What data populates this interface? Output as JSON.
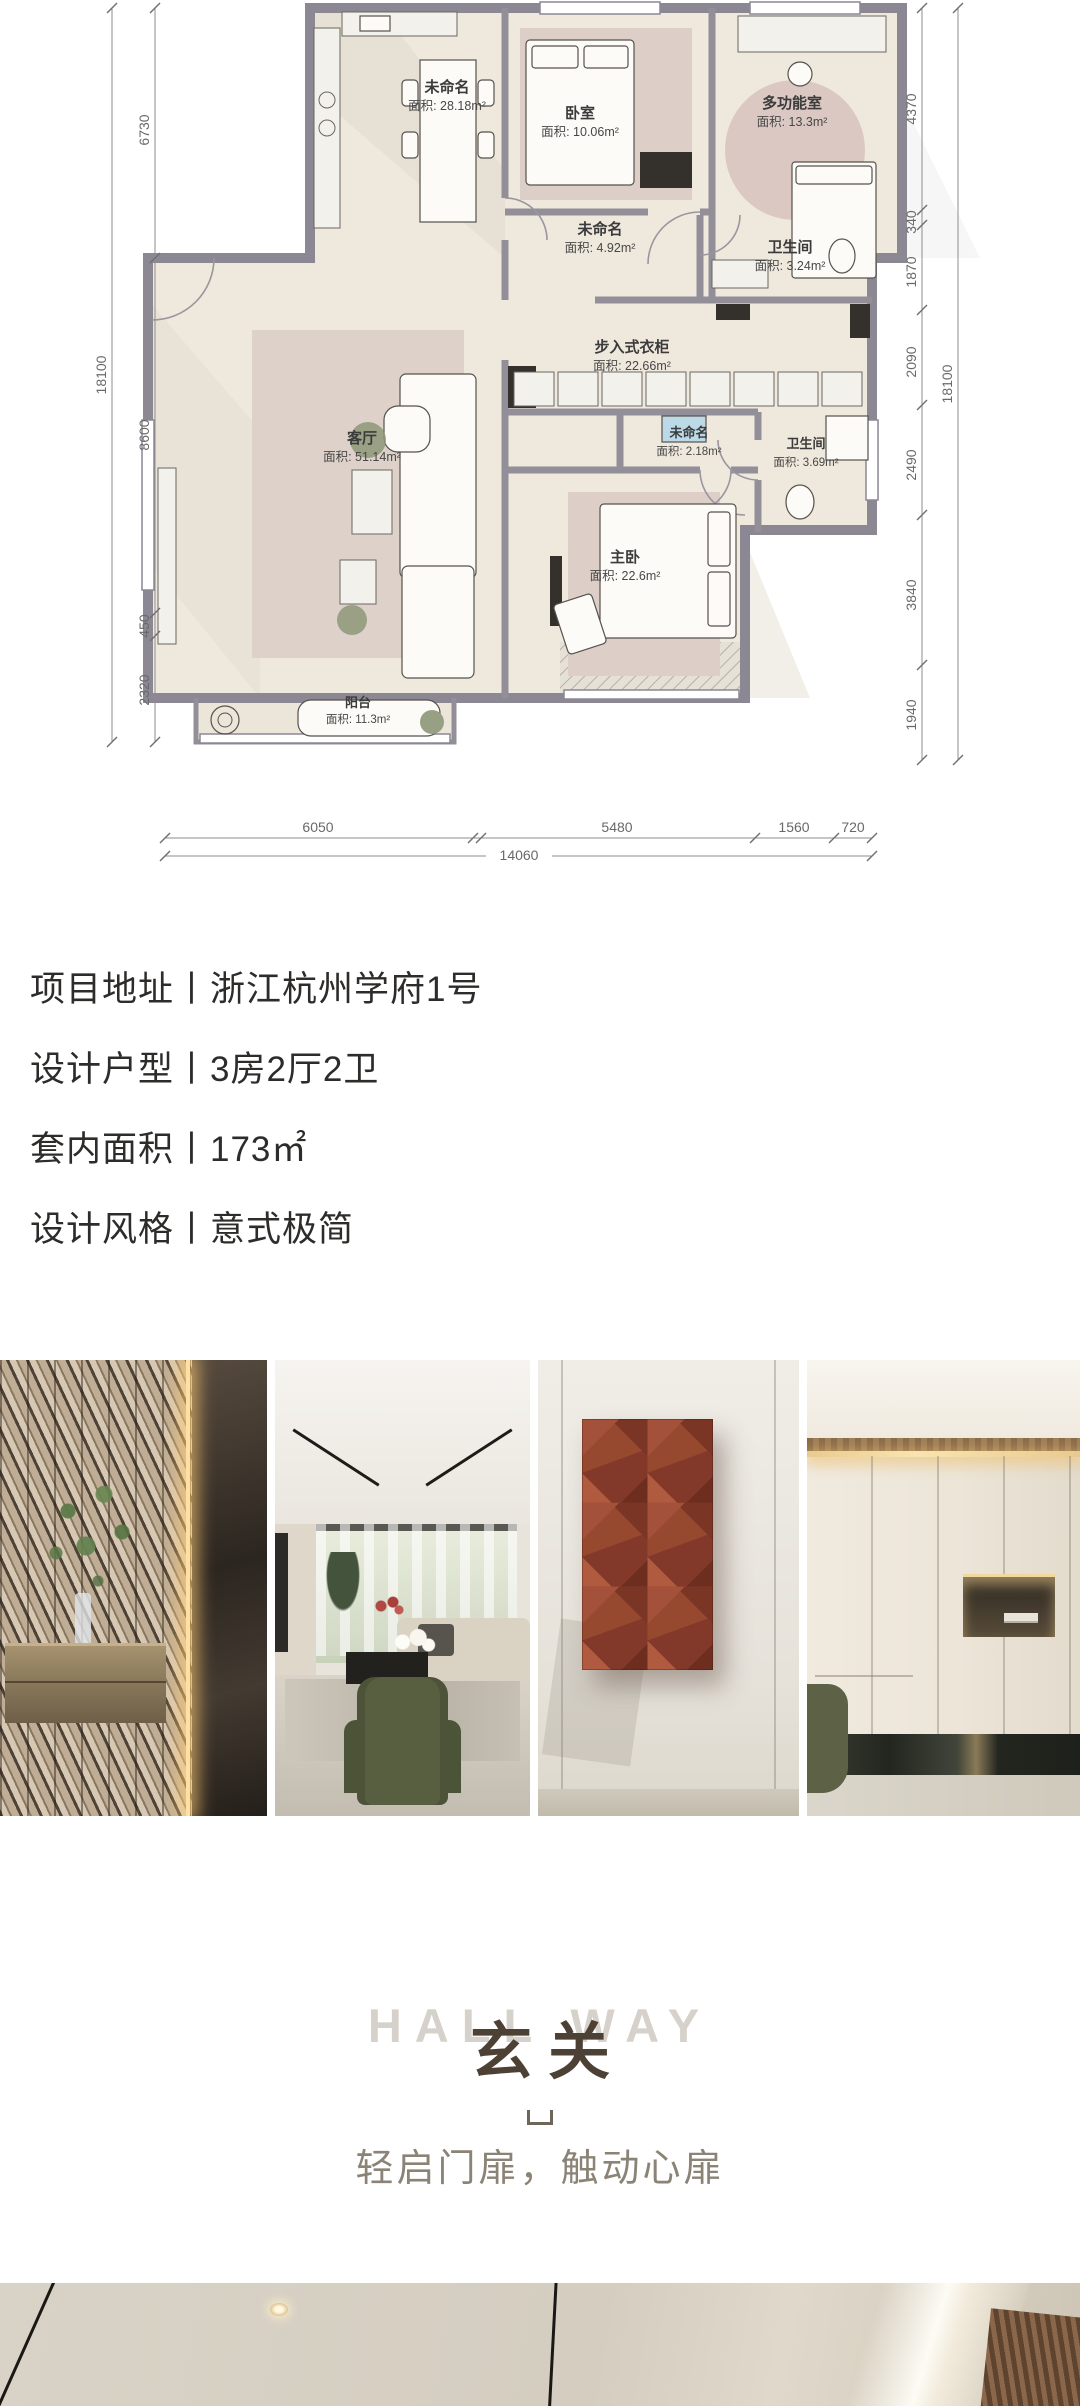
{
  "floor_plan": {
    "rooms": [
      {
        "name": "未命名",
        "area": "面积: 28.18m²"
      },
      {
        "name": "卧室",
        "area": "面积: 10.06m²"
      },
      {
        "name": "多功能室",
        "area": "面积: 13.3m²"
      },
      {
        "name": "未命名",
        "area": "面积: 4.92m²"
      },
      {
        "name": "卫生间",
        "area": "面积: 3.24m²"
      },
      {
        "name": "步入式衣柜",
        "area": "面积: 22.66m²"
      },
      {
        "name": "未命名",
        "area": "面积: 2.18m²"
      },
      {
        "name": "卫生间",
        "area": "面积: 3.69m²"
      },
      {
        "name": "客厅",
        "area": "面积: 51.14m²"
      },
      {
        "name": "主卧",
        "area": "面积: 22.6m²"
      },
      {
        "name": "阳台",
        "area": "面积: 11.3m²"
      }
    ],
    "dims": {
      "left_total": "18100",
      "left": [
        "6730",
        "8600",
        "450",
        "2320"
      ],
      "right": [
        "4370",
        "340",
        "1870",
        "2090",
        "2490",
        "3840",
        "1940"
      ],
      "right_total": "18100",
      "bottom": [
        "6050",
        "5480",
        "1560",
        "720"
      ],
      "bottom_total": "14060"
    }
  },
  "project_info": {
    "address": "项目地址丨浙江杭州学府1号",
    "layout": "设计户型丨3房2厅2卫",
    "area": "套内面积丨173㎡",
    "style": "设计风格丨意式极简"
  },
  "hallway": {
    "title_en": "HALL WAY",
    "title_cn": "玄关",
    "tagline": "轻启门扉，触动心扉"
  },
  "colors": {
    "accent_rust": "#8e4430",
    "title_dark": "#4c4134",
    "title_light": "#d6d2cb",
    "tagline_gray": "#8b8376",
    "wall_gray": "#8b8793",
    "floor_beige": "#efe8dd"
  }
}
